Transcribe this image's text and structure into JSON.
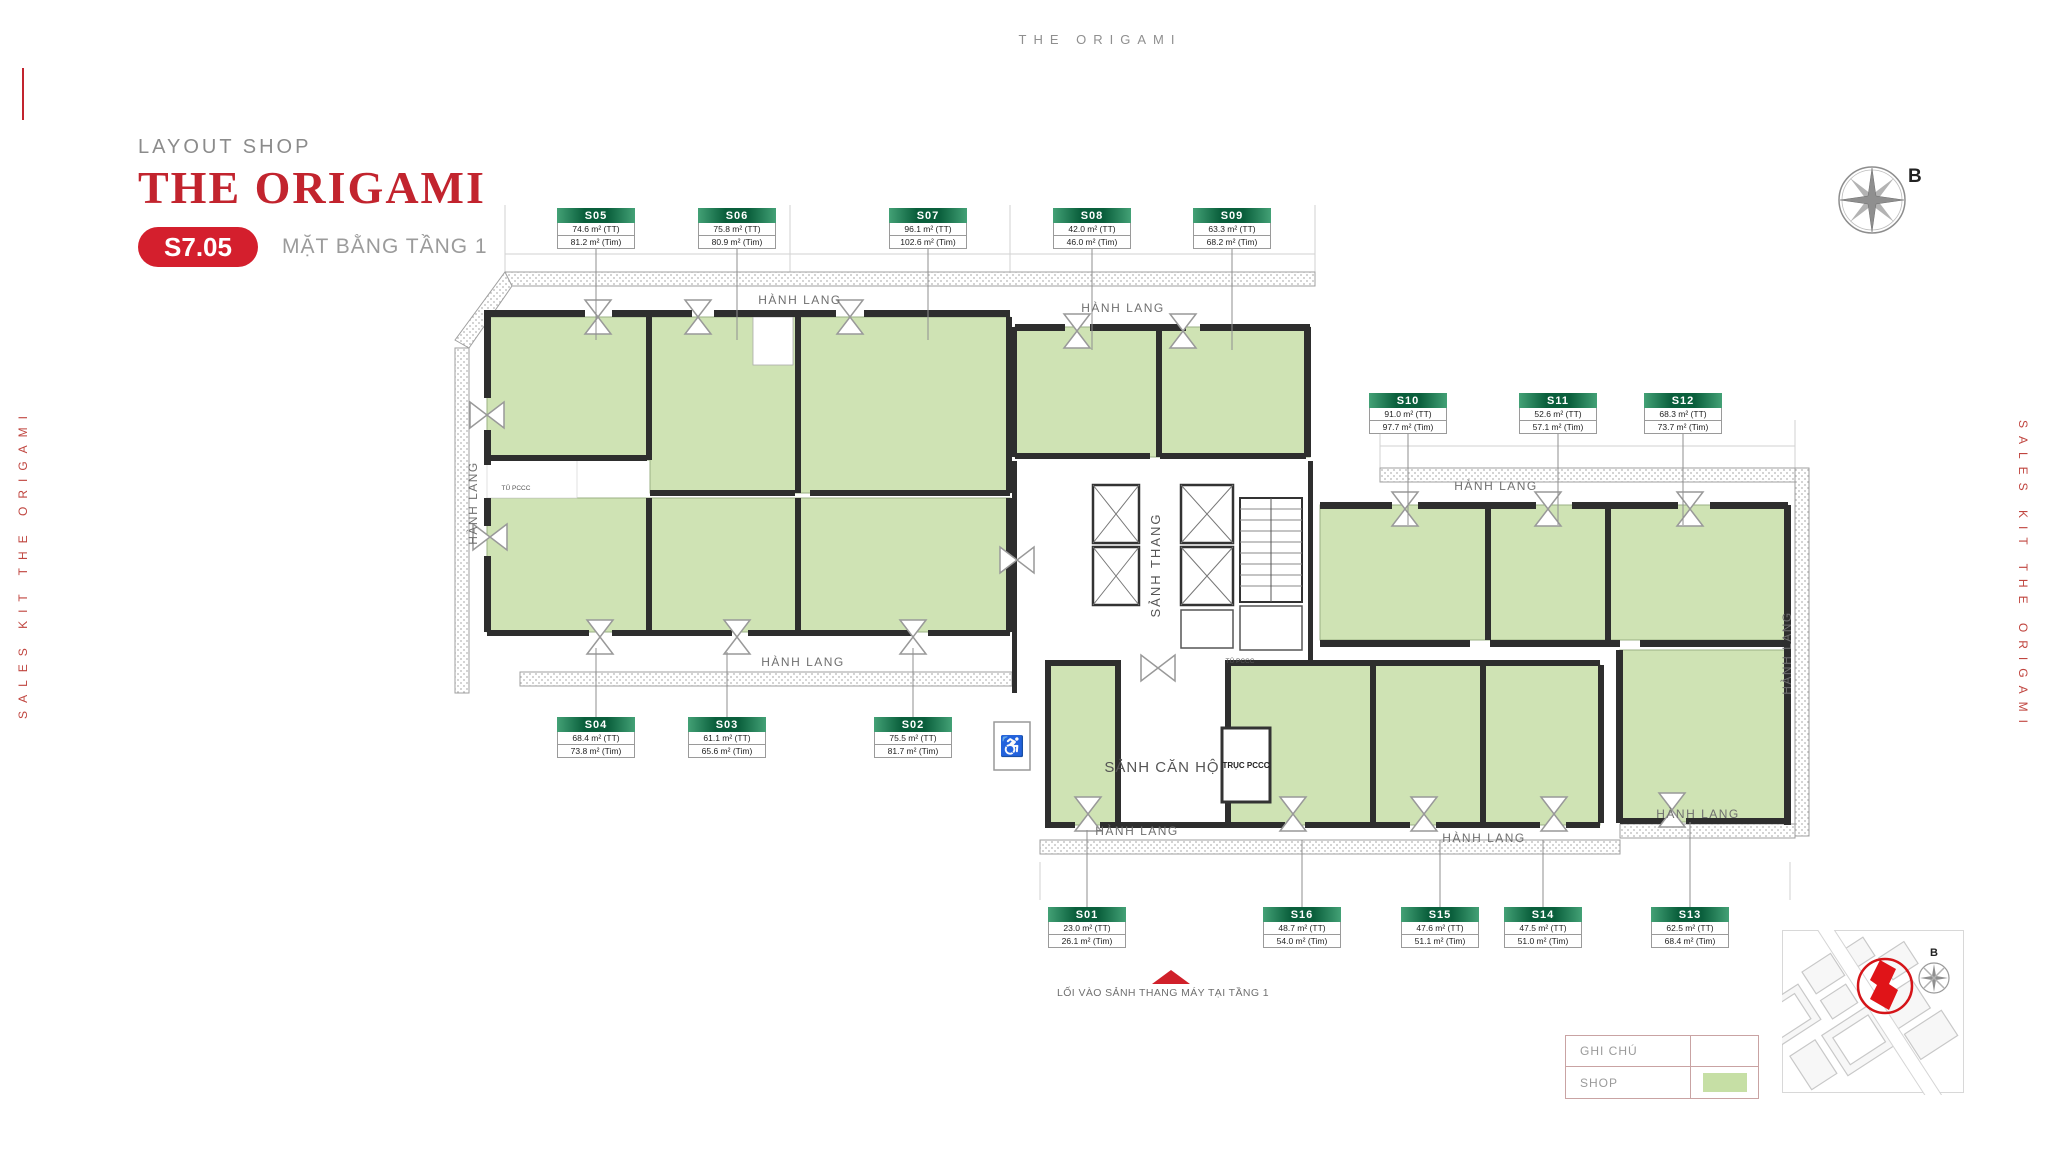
{
  "header": {
    "top_title": "THE ORIGAMI",
    "eyebrow": "LAYOUT SHOP",
    "title": "THE ORIGAMI",
    "unit_badge": "S7.05",
    "subtitle": "MẶT BẰNG TẦNG 1"
  },
  "side_text": "SALES KIT THE ORIGAMI",
  "compass": {
    "north_label": "B"
  },
  "colors": {
    "brand_red": "#c2242e",
    "badge_red": "#d41f2d",
    "side_red": "#c0453f",
    "shop_green": "#cfe3b4",
    "swatch_green": "#c6dfa5",
    "hdr_green_a": "#43a176",
    "hdr_green_b": "#0a5f3c"
  },
  "plan": {
    "corridor_label": "HÀNH LANG",
    "stair_lobby_label": "SẢNH THANG",
    "apartment_lobby_label": "SẢNH CĂN HỘ",
    "fire_duct_label": "TRỤC PCCC",
    "fire_cabinet_label": "TỦ PCCC",
    "entrance_note": "LỐI VÀO SẢNH THANG MÁY TẠI TẦNG 1",
    "wheelchair_icon": "♿",
    "units": [
      {
        "id": "S01",
        "tt": "23.0 m² (TT)",
        "tim": "26.1 m² (Tim)",
        "cx": 1087,
        "top": 907,
        "leader_to": 830
      },
      {
        "id": "S02",
        "tt": "75.5 m² (TT)",
        "tim": "81.7 m² (Tim)",
        "cx": 913,
        "top": 717,
        "leader_to": 648
      },
      {
        "id": "S03",
        "tt": "61.1 m² (TT)",
        "tim": "65.6 m² (Tim)",
        "cx": 727,
        "top": 717,
        "leader_to": 652
      },
      {
        "id": "S04",
        "tt": "68.4 m² (TT)",
        "tim": "73.8 m² (Tim)",
        "cx": 596,
        "top": 717,
        "leader_to": 648
      },
      {
        "id": "S05",
        "tt": "74.6 m² (TT)",
        "tim": "81.2 m² (Tim)",
        "cx": 596,
        "top": 208,
        "leader_to": 340
      },
      {
        "id": "S06",
        "tt": "75.8 m² (TT)",
        "tim": "80.9 m² (Tim)",
        "cx": 737,
        "top": 208,
        "leader_to": 340
      },
      {
        "id": "S07",
        "tt": "96.1 m² (TT)",
        "tim": "102.6 m² (Tim)",
        "cx": 928,
        "top": 208,
        "leader_to": 340
      },
      {
        "id": "S08",
        "tt": "42.0 m² (TT)",
        "tim": "46.0 m² (Tim)",
        "cx": 1092,
        "top": 208,
        "leader_to": 350
      },
      {
        "id": "S09",
        "tt": "63.3 m² (TT)",
        "tim": "68.2 m² (Tim)",
        "cx": 1232,
        "top": 208,
        "leader_to": 350
      },
      {
        "id": "S10",
        "tt": "91.0 m² (TT)",
        "tim": "97.7 m² (Tim)",
        "cx": 1408,
        "top": 393,
        "leader_to": 525
      },
      {
        "id": "S11",
        "tt": "52.6 m² (TT)",
        "tim": "57.1 m² (Tim)",
        "cx": 1558,
        "top": 393,
        "leader_to": 525
      },
      {
        "id": "S12",
        "tt": "68.3 m² (TT)",
        "tim": "73.7 m² (Tim)",
        "cx": 1683,
        "top": 393,
        "leader_to": 525
      },
      {
        "id": "S13",
        "tt": "62.5 m² (TT)",
        "tim": "68.4 m² (Tim)",
        "cx": 1690,
        "top": 907,
        "leader_to": 822
      },
      {
        "id": "S14",
        "tt": "47.5 m² (TT)",
        "tim": "51.0 m² (Tim)",
        "cx": 1543,
        "top": 907,
        "leader_to": 840
      },
      {
        "id": "S15",
        "tt": "47.6 m² (TT)",
        "tim": "51.1 m² (Tim)",
        "cx": 1440,
        "top": 907,
        "leader_to": 840
      },
      {
        "id": "S16",
        "tt": "48.7 m² (TT)",
        "tim": "54.0 m² (Tim)",
        "cx": 1302,
        "top": 907,
        "leader_to": 840
      }
    ]
  },
  "legend": {
    "title": "GHI CHÚ",
    "rows": [
      {
        "label": "SHOP",
        "swatch": "#c6dfa5"
      }
    ]
  },
  "minimap": {
    "north_label": "B"
  }
}
